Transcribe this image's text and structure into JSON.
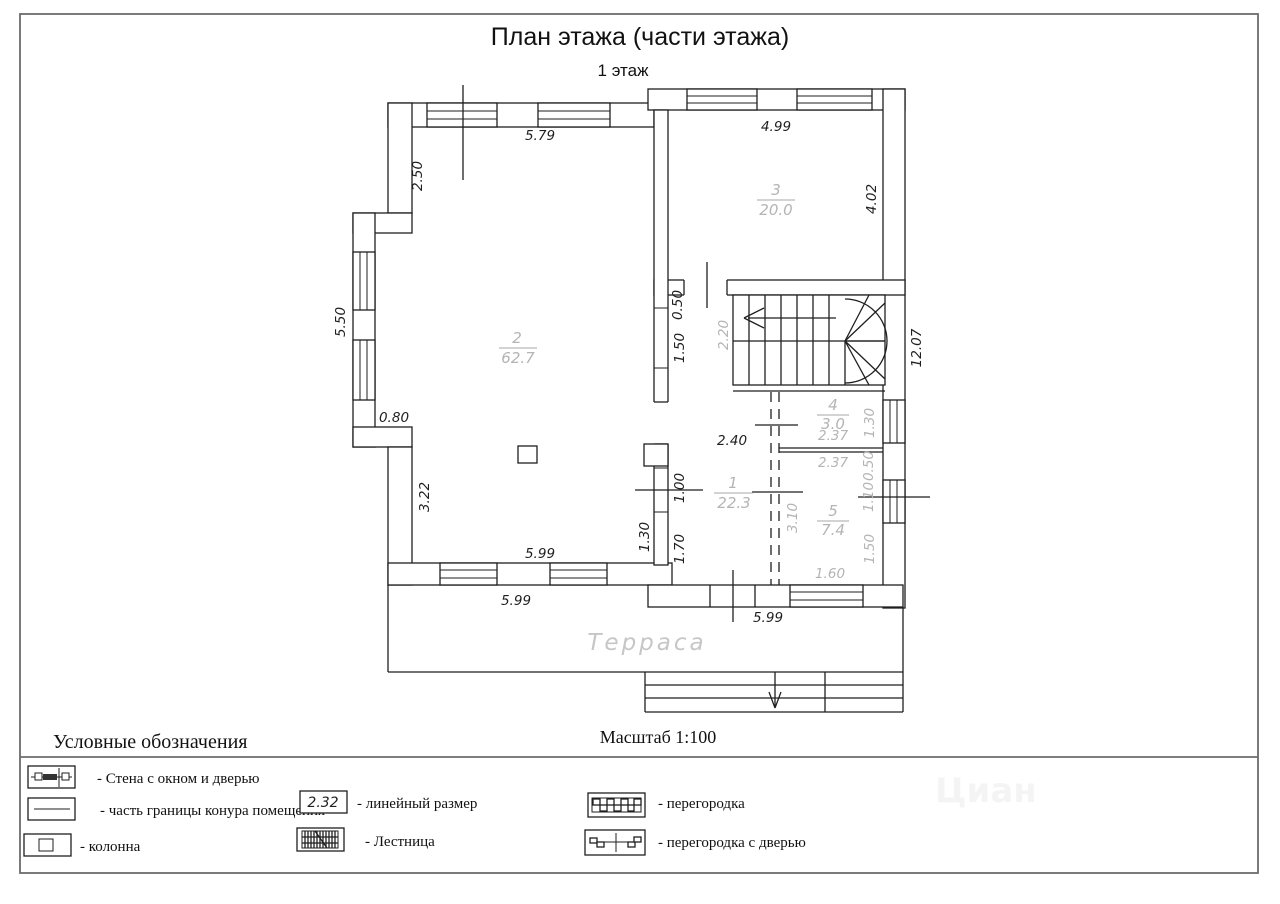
{
  "sheet": {
    "title": "План этажа (части этажа)",
    "subtitle": "1 этаж",
    "scale_label": "Масштаб 1:100",
    "watermark": "Циан"
  },
  "rooms": [
    {
      "id": "1",
      "area": "22.3"
    },
    {
      "id": "2",
      "area": "62.7"
    },
    {
      "id": "3",
      "area": "20.0"
    },
    {
      "id": "4",
      "area": "3.0"
    },
    {
      "id": "5",
      "area": "7.4"
    }
  ],
  "terrace_label": "Терраса",
  "dims": {
    "top_room2": "5.79",
    "top_room3": "4.99",
    "left_upper": "2.50",
    "left_bay": "5.50",
    "left_step": "0.80",
    "left_lower": "3.22",
    "room3_right": "4.02",
    "right_total": "12.07",
    "mid_top_a": "0.50",
    "mid_top_b": "1.50",
    "stair_width": "2.20",
    "hall_width": "2.40",
    "mid_low_a": "1.00",
    "mid_low_b": "1.70",
    "mid_door": "1.30",
    "room2_bottom": "5.99",
    "terrace_top": "5.99",
    "hall_bottom": "5.99",
    "room4_width": "2.37",
    "room5_width": "2.37",
    "room4_height": "1.30",
    "wall_seg_050": "0.50",
    "window_110": "1.10",
    "room5_height": "3.10",
    "wall_seg_150": "1.50",
    "window_160": "1.60"
  },
  "legend": {
    "heading": "Условные обозначения",
    "wall_window_door": "-  Стена с окном и дверью",
    "contour": "- часть границы конура помещения",
    "column": "-  колонна",
    "linear_size": "-  линейный размер",
    "linear_size_sample": "2.32",
    "stairs": "-  Лестница",
    "partition": "- перегородка",
    "partition_door": "- перегородка с дверью"
  }
}
